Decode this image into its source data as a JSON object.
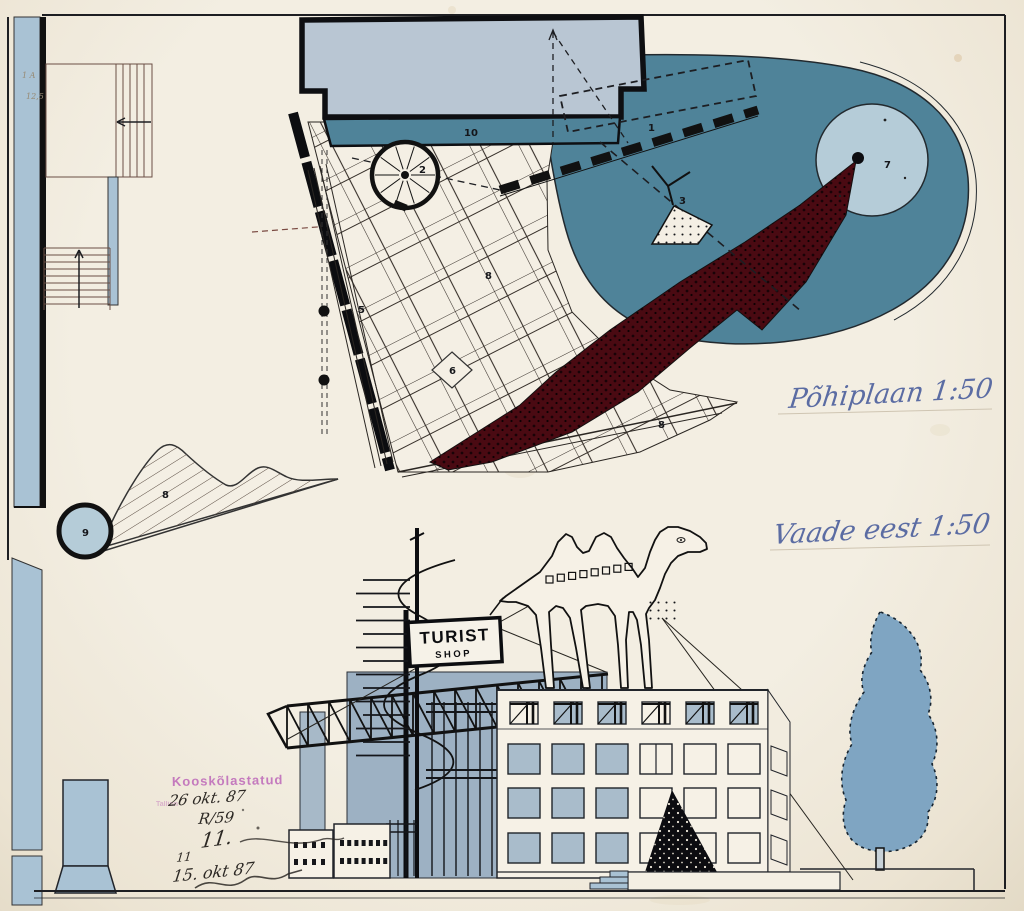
{
  "palette": {
    "paper": "#f1ecdf",
    "teal": "#4f8399",
    "light_blue": "#b5ccd8",
    "footprint_blue": "#b9c6d3",
    "slab_blue": "#9db1c3",
    "window_blue": "#a9bccb",
    "strip_blue": "#a9c2d4",
    "tree_blue": "#7fa5c2",
    "maroon": "#4a0a12",
    "ink_black": "#2c2824",
    "ink_blue": "#5b6ca3",
    "stamp_purple": "#b85ab5",
    "line_black": "#17181c"
  },
  "annotations": {
    "plan_title": "Põhiplaan 1:50",
    "elevation_title": "Vaade eest 1:50",
    "stamp_text": "Kooskõlastatud",
    "stamp_city": "Tallinn",
    "ink_note_1": "26 okt. 87",
    "ink_note_2": "R/59",
    "ink_note_3": "11.",
    "ink_note_4": "11",
    "ink_note_5": "15. okt 87",
    "pencil_note_1": "1 A",
    "pencil_note_2": "12,5"
  },
  "sign": {
    "line1": "TURIST",
    "line2": "SHOP"
  },
  "plan_labels": {
    "flag_wall": "1",
    "spiral_stair": "2",
    "pond_triangle": "3",
    "wall_lines": "5",
    "diamond": "6",
    "pond_circle": "7",
    "paving_a": "8",
    "paving_b": "8",
    "hill": "8",
    "roll": "9",
    "canopy": "10"
  },
  "elevation": {
    "windows": {
      "rows": [
        [
          "w",
          "b",
          "b",
          "w",
          "b",
          "b"
        ],
        [
          "b",
          "b",
          "b",
          "split",
          "w",
          "w"
        ],
        [
          "b",
          "b",
          "b",
          "w",
          "w",
          "w"
        ],
        [
          "b",
          "b",
          "b",
          "w",
          "w",
          "w"
        ]
      ]
    }
  }
}
